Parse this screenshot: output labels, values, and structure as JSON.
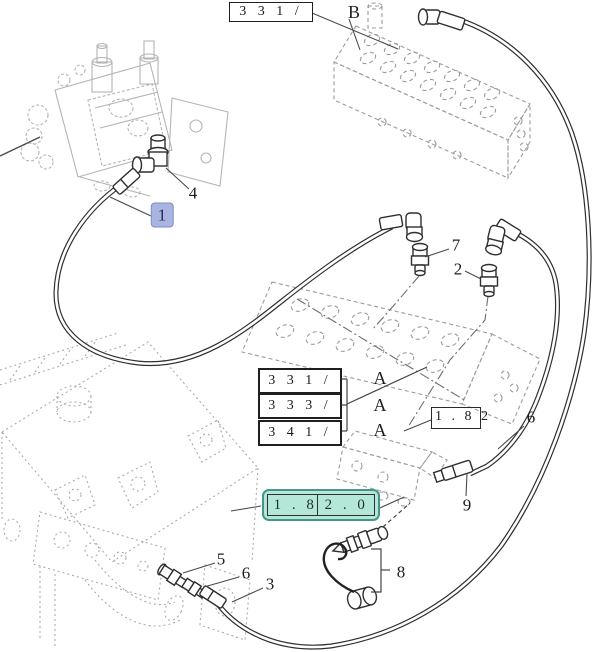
{
  "diagram": {
    "ref_boxes": {
      "top": "3 3 1 /",
      "stack_1": "3 3 1 /",
      "stack_2": "3 3 3 /",
      "stack_3": "3 4 1 /",
      "section": "1 . 8 2",
      "section_detail": "1 . 8 2 . 0"
    },
    "view_letters": {
      "b": "B",
      "a1": "A",
      "a2": "A",
      "a3": "A"
    },
    "callouts": {
      "item_1": "1",
      "item_2": "2",
      "item_3": "3",
      "item_4": "4",
      "item_5": "5",
      "item_6_upper": "6",
      "item_6_lower": "6",
      "item_7": "7",
      "item_8": "8",
      "item_9": "9"
    },
    "colors": {
      "selected_highlight": "#a9b5e0",
      "reference_highlight": "#b5e7d9",
      "line_dark": "#2f2f2f",
      "ghost_gray": "#b5b5b5"
    }
  }
}
